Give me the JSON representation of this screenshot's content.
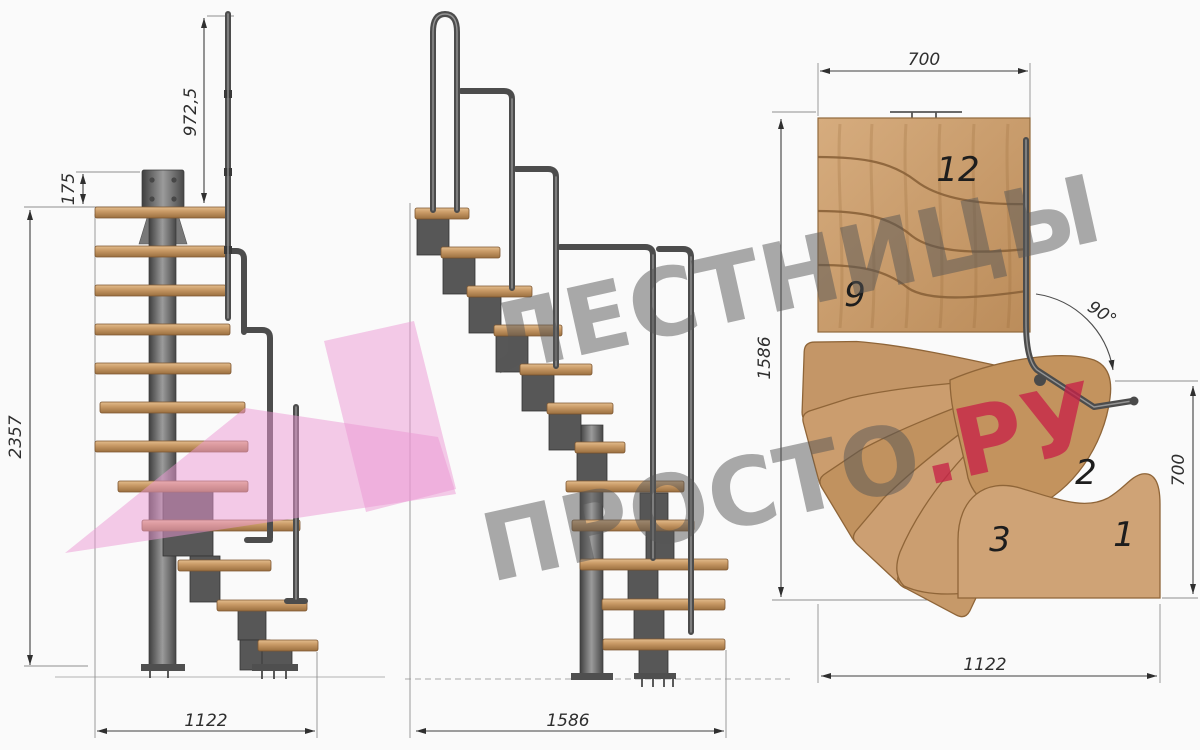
{
  "watermark": {
    "line1": "ЛЕСТНИЦЫ",
    "line2_gray": "ПРОСТО",
    "line2_accent": ".РУ",
    "gray_color": "#9a9a9a",
    "accent_color": "#c72348",
    "logo_color": "#ec97d4"
  },
  "front_view": {
    "dims": {
      "total_height": "2357",
      "rail_height": "972,5",
      "plate_offset": "175",
      "width": "1122"
    }
  },
  "side_view": {
    "dims": {
      "width": "1586"
    }
  },
  "plan_view": {
    "dims": {
      "landing_width": "700",
      "depth": "1586",
      "turn_angle": "90°",
      "entry_depth": "700",
      "width": "1122"
    },
    "step_numbers": {
      "s12": "12",
      "s9": "9",
      "s3": "3",
      "s2": "2",
      "s1": "1"
    }
  }
}
